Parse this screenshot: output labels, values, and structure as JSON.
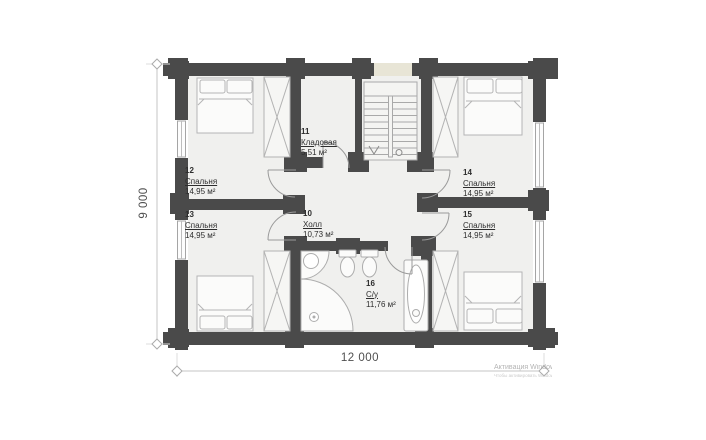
{
  "plan": {
    "dim_width": "12 000",
    "dim_height": "9 000",
    "rooms": [
      {
        "id": "10",
        "name": "Холл",
        "area": "10,73 м²"
      },
      {
        "id": "11",
        "name": "Кладовая",
        "area": "5,51 м²"
      },
      {
        "id": "12",
        "name": "Спальня",
        "area": "14,95 м²"
      },
      {
        "id": "13",
        "name": "Спальня",
        "area": "14,95 м²"
      },
      {
        "id": "14",
        "name": "Спальня",
        "area": "14,95 м²"
      },
      {
        "id": "15",
        "name": "Спальня",
        "area": "14,95 м²"
      },
      {
        "id": "16",
        "name": "С/у",
        "area": "11,76 м²"
      }
    ]
  },
  "watermark": {
    "line1": "Активация Windows",
    "line2": "Чтобы активировать Windows, перейдите в раздел \"Параметры\"."
  },
  "colors": {
    "wall": "#4a4a4a",
    "room_fill": "#f0f0ee",
    "window_accent": "#e8e5d6",
    "furniture_line": "#b3b3b3"
  }
}
